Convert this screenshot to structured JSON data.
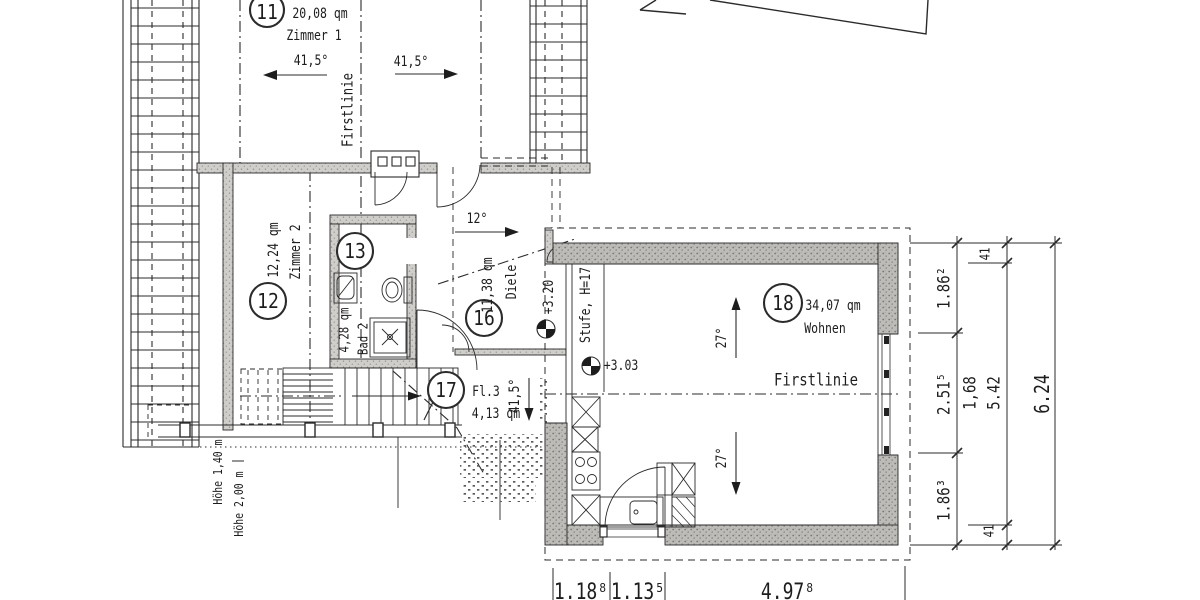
{
  "plan": {
    "rooms": [
      {
        "num": "11",
        "area": "20,08 qm",
        "name": "Zimmer 1"
      },
      {
        "num": "12",
        "area": "12,24 qm",
        "name": "Zimmer 2"
      },
      {
        "num": "13",
        "area": "4,28 qm",
        "name": "Bad 2"
      },
      {
        "num": "16",
        "area": "11,38 qm",
        "name": "Diele"
      },
      {
        "num": "17",
        "area": "4,13 qm",
        "name": "Fl.3"
      },
      {
        "num": "18",
        "area": "34,07 qm",
        "name": "Wohnen"
      }
    ],
    "roof_angles": {
      "zimmer1_left": "41,5°",
      "zimmer1_right": "41,5°",
      "dormer": "12°",
      "fl3": "41,5°",
      "wohnen_upper": "27°",
      "wohnen_lower": "27°"
    },
    "ridge": {
      "vertical": "Firstlinie",
      "horizontal": "Firstlinie"
    },
    "levels": {
      "diele": "+3.20",
      "wohnen": "+3.03",
      "step": "Stufe, H=17"
    },
    "heights": {
      "line_140": "Höhe 1,40 m",
      "line_200": "Höhe 2,00 m"
    },
    "dims_right": {
      "seg_41_top": "41",
      "seg_186_top": "1.86²",
      "seg_251": "2.51⁵",
      "seg_168": "1,68",
      "seg_542": "5.42",
      "total": "6.24",
      "seg_186_bottom": "1.86³",
      "seg_41_bottom": "41"
    },
    "dims_bottom": {
      "seg1": "1.18⁸",
      "seg2": "1.13⁵",
      "seg3": "4.97⁸"
    },
    "colors": {
      "line": "#2b2b2b",
      "wall_fill": "#bdbcb9"
    }
  }
}
